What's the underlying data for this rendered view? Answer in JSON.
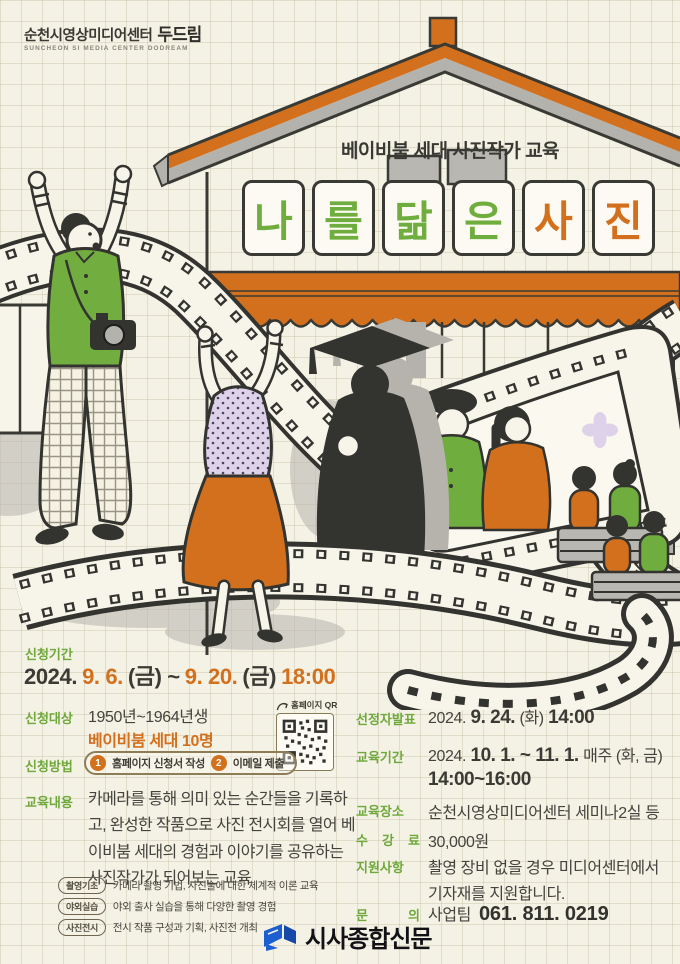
{
  "logo": {
    "title": "순천시영상미디어센터",
    "brand": "두드림",
    "subtitle": "SUNCHEON SI MEDIA CENTER DODREAM"
  },
  "title": {
    "eyebrow": "베이비붐 세대 사진작가 교육",
    "letters": [
      "나",
      "를",
      "닮",
      "은",
      "사",
      "진"
    ]
  },
  "apply_period": {
    "label": "신청기간",
    "p1": "2024.",
    "p2": "9. 6.",
    "p3": "(금) ~",
    "p4": "9. 20.",
    "p5": "(금)",
    "p6": "18:00"
  },
  "left": {
    "target": {
      "label": "신청대상",
      "line1": "1950년~1964년생",
      "line2": "베이비붐 세대 10명"
    },
    "qr_label": "홈페이지 QR",
    "method": {
      "label": "신청방법",
      "steps": [
        {
          "num": "1",
          "text": "홈페이지 신청서 작성"
        },
        {
          "num": "2",
          "text": "이메일 제출"
        }
      ]
    },
    "curriculum": {
      "label": "교육내용",
      "paragraph": "카메라를 통해 의미 있는 순간들을 기록하고, 완성한 작품으로 사진 전시회를 열어 베이비붐 세대의 경험과 이야기를 공유하는 사진작가가 되어보는 교육",
      "items": [
        {
          "tag": "촬영기초",
          "desc": "카메라 촬영 기법, 사진술에 대한 체계적 이론 교육"
        },
        {
          "tag": "야외실습",
          "desc": "야외 출사 실습을 통해 다양한 촬영 경험"
        },
        {
          "tag": "사진전시",
          "desc": "전시 작품 구성과 기획, 사진전 개최"
        }
      ]
    }
  },
  "right": {
    "announcement": {
      "label": "선정자발표",
      "year": "2024.",
      "date": "9. 24.",
      "day": "(화)",
      "time": "14:00"
    },
    "edu_period": {
      "label": "교육기간",
      "year": "2024.",
      "range": "10. 1. ~ 11. 1.",
      "weekly": "매주 (화, 금)",
      "time": "14:00~16:00"
    },
    "edu_place": {
      "label": "교육장소",
      "value": "순천시영상미디어센터 세미나2실 등"
    },
    "fee": {
      "label": "수 강 료",
      "value": "30,000원"
    },
    "support": {
      "label": "지원사항",
      "line1": "촬영 장비 없을 경우 미디어센터에서",
      "line2": "기자재를 지원합니다."
    },
    "contact": {
      "label": "문 의",
      "team": "사업팀",
      "phone": "061. 811. 0219"
    }
  },
  "watermark": {
    "text": "시사종합신문"
  },
  "icons": {
    "qr": "qr-code-icon",
    "arrow": "curved-arrow-icon",
    "watermark_logo": "newspaper-logo-icon"
  },
  "colors": {
    "accent_orange": "#d2701e",
    "accent_green": "#6fae3e",
    "label_green": "#6fa93c",
    "text_dark": "#3b3b35",
    "background": "#f4f1e5",
    "lavender": "#ddd2ea",
    "gray": "#b4b2ad",
    "watermark_blue": "#1d5fd1"
  }
}
